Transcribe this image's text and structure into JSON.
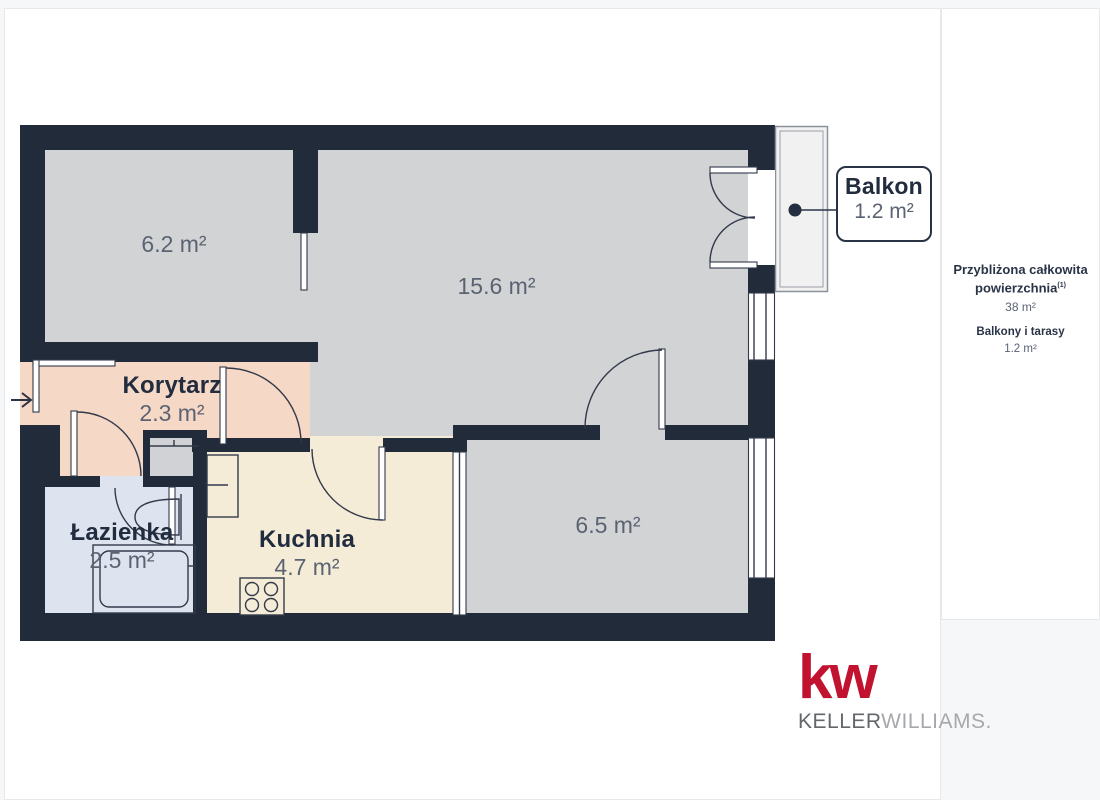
{
  "floorplan": {
    "rooms": [
      {
        "name": "",
        "area": "6.2 m²"
      },
      {
        "name": "",
        "area": "15.6 m²"
      },
      {
        "name": "Korytarz",
        "area": "2.3 m²"
      },
      {
        "name": "Łazienka",
        "area": "2.5 m²"
      },
      {
        "name": "Kuchnia",
        "area": "4.7 m²"
      },
      {
        "name": "",
        "area": "6.5 m²"
      },
      {
        "name": "Balkon",
        "area": "1.2 m²"
      }
    ],
    "entrance_arrow": "→"
  },
  "sidebar": {
    "total_label_line1": "Przybliżona całkowita",
    "total_label_line2": "powierzchnia",
    "total_superscript": "(1)",
    "total_value": "38 m²",
    "balcony_label": "Balkony i tarasy",
    "balcony_value": "1.2 m²"
  },
  "branding": {
    "logo_mark": "kw",
    "logo_name_bold": "KELLER",
    "logo_name_light": "WILLIAMS."
  },
  "colors": {
    "bg": "#f6f7f8",
    "wall": "#212b3a",
    "room": "#d2d3d5",
    "corridor": "#f6d8c6",
    "kitchen": "#f5ecd8",
    "bath": "#dee3f0",
    "shaft": "#d0d2d5",
    "balcony": "#f1f1f2",
    "line": "#323a4a",
    "kw-red": "#c1122f"
  }
}
